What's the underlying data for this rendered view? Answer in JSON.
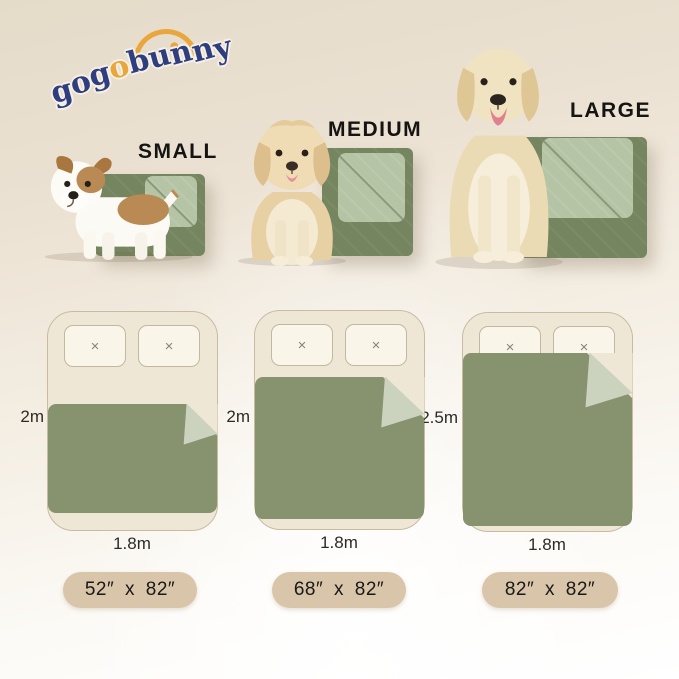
{
  "brand": {
    "logo_text": "gogobunny",
    "accent_letter_index": 3,
    "navy": "#2E3E7F",
    "orange": "#E9A63C"
  },
  "products": [
    {
      "size_label": "SMALL",
      "bed_length": "2m",
      "bed_width": "1.8m",
      "blanket_size": "52″ x 82″"
    },
    {
      "size_label": "MEDIUM",
      "bed_length": "2m",
      "bed_width": "1.8m",
      "blanket_size": "68″ x 82″"
    },
    {
      "size_label": "LARGE",
      "bed_length": "2.5m",
      "bed_width": "1.8m",
      "blanket_size": "82″ x 82″"
    }
  ],
  "icons": {
    "pillow_stitch": "×"
  },
  "colors": {
    "background_top": "#E5DBC9",
    "background_bottom": "#FFFFFF",
    "blanket_dark_green": "#75855F",
    "blanket_fold_light_green": "#B5C4A5",
    "diagram_blanket_green": "#87926F",
    "diagram_fold_green": "#CBD3BF",
    "bed_fill": "#EFE7D5",
    "pillow_fill": "#F9F5E8",
    "pill_fill": "#D9C5A9"
  }
}
